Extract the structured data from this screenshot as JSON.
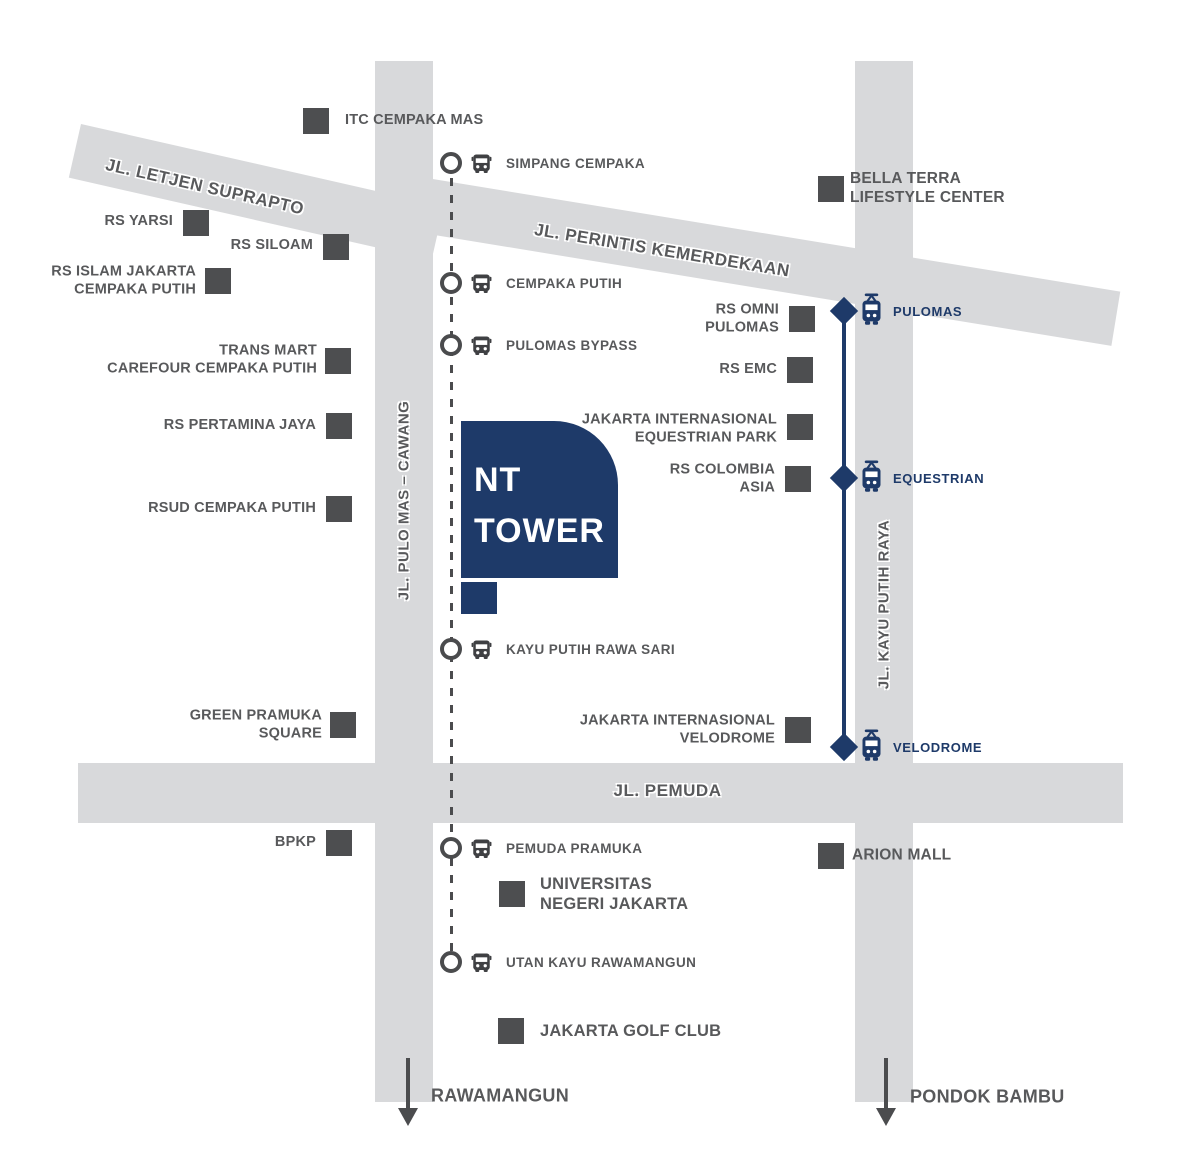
{
  "tower": {
    "line1": "NT",
    "line2": "TOWER"
  },
  "roads": {
    "letjen": "JL. LETJEN SUPRAPTO",
    "perintis": "JL. PERINTIS KEMERDEKAAN",
    "pulomas_cawang": "JL. PULO MAS – CAWANG",
    "kayu_putih": "JL. KAYU PUTIH RAYA",
    "pemuda": "JL. PEMUDA"
  },
  "bus_stops": [
    "SIMPANG CEMPAKA",
    "CEMPAKA PUTIH",
    "PULOMAS BYPASS",
    "KAYU PUTIH RAWA SARI",
    "PEMUDA PRAMUKA",
    "UTAN KAYU RAWAMANGUN"
  ],
  "stations": [
    "PULOMAS",
    "EQUESTRIAN",
    "VELODROME"
  ],
  "landmarks": [
    {
      "lines": [
        "ITC CEMPAKA MAS"
      ]
    },
    {
      "lines": [
        "RS YARSI"
      ]
    },
    {
      "lines": [
        "RS SILOAM"
      ]
    },
    {
      "lines": [
        "RS ISLAM JAKARTA",
        "CEMPAKA PUTIH"
      ]
    },
    {
      "lines": [
        "TRANS MART",
        "CAREFOUR CEMPAKA PUTIH"
      ]
    },
    {
      "lines": [
        "RS PERTAMINA JAYA"
      ]
    },
    {
      "lines": [
        "RSUD CEMPAKA PUTIH"
      ]
    },
    {
      "lines": [
        "GREEN PRAMUKA",
        "SQUARE"
      ]
    },
    {
      "lines": [
        "BPKP"
      ]
    },
    {
      "lines": [
        "BELLA TERRA",
        "LIFESTYLE CENTER"
      ]
    },
    {
      "lines": [
        "RS OMNI",
        "PULOMAS"
      ]
    },
    {
      "lines": [
        "RS EMC"
      ]
    },
    {
      "lines": [
        "JAKARTA INTERNASIONAL",
        "EQUESTRIAN PARK"
      ]
    },
    {
      "lines": [
        "RS COLOMBIA",
        "ASIA"
      ]
    },
    {
      "lines": [
        "JAKARTA INTERNASIONAL",
        "VELODROME"
      ]
    },
    {
      "lines": [
        "ARION MALL"
      ]
    },
    {
      "lines": [
        "UNIVERSITAS",
        "NEGERI JAKARTA"
      ]
    },
    {
      "lines": [
        "JAKARTA GOLF CLUB"
      ]
    }
  ],
  "destinations": {
    "left": "RAWAMANGUN",
    "right": "PONDOK BAMBU"
  },
  "colors": {
    "navy": "#1e3a69",
    "road_gray": "#d8d9db",
    "marker_gray": "#4d4e50",
    "text_gray": "#58595b"
  }
}
